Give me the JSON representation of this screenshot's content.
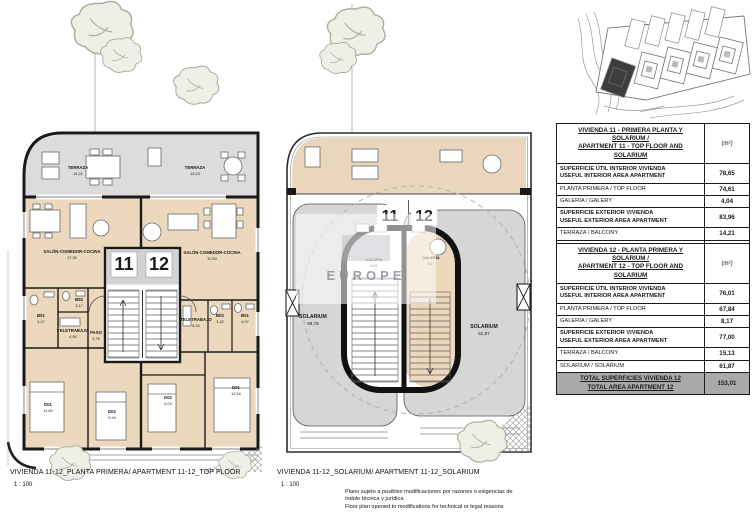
{
  "sheet": {
    "watermark": "EUROPE",
    "disclaimer_es": "Plano sujeto a posibles modificaciones por razones o exigencias de índole técnica y jurídica",
    "disclaimer_en": "Floor plan opened to modifications for technical or legal reasons"
  },
  "plan_top_floor": {
    "caption": "VIVIENDA 11-12_PLANTA PRIMERA/ APARTMENT 11-12_TOP FLOOR",
    "scale": "1 : 100",
    "unit_left": "11",
    "unit_right": "12",
    "rooms": {
      "terraza_11": {
        "name": "TERRAZA",
        "area": "14,21"
      },
      "terraza_12": {
        "name": "TERRAZA",
        "area": "15,13"
      },
      "salon_11": {
        "name": "SALÓN-COMEDOR-COCINA",
        "area": "27,36"
      },
      "salon_12": {
        "name": "SALÓN-COMEDOR-COCINA",
        "area": "30,50"
      },
      "b01_11": {
        "name": "B01",
        "area": "3,47"
      },
      "b02_11": {
        "name": "B02",
        "area": "3,17"
      },
      "teletrabajo_11": {
        "name": "TELETRABAJO",
        "area": "4,50"
      },
      "paso_11": {
        "name": "PASO",
        "area": "3,76"
      },
      "d01_11": {
        "name": "D01",
        "area": "11,69"
      },
      "d02_11": {
        "name": "D02",
        "area": "9,49"
      },
      "teletrabajo_12": {
        "name": "TELETRABAJO",
        "area": "5,34"
      },
      "b01_12": {
        "name": "B01",
        "area": "4,07"
      },
      "b02_12": {
        "name": "B02",
        "area": "3,42"
      },
      "d01_12": {
        "name": "D01",
        "area": "12,94"
      },
      "d02_12": {
        "name": "D02",
        "area": "9,04"
      }
    }
  },
  "plan_solarium": {
    "caption": "VIVIENDA 11-12_SOLARIUM/ APARTMENT 11-12_SOLARIUM",
    "scale": "1 : 100",
    "unit_left": "11",
    "unit_right": "12",
    "labels": {
      "solarium_11": {
        "name": "SOLARIUM",
        "area": "69,75"
      },
      "solarium_12": {
        "name": "SOLARIUM",
        "area": "61,87"
      },
      "galeria_11": {
        "name": "GALERÍA",
        "area": "4,04"
      },
      "galeria_12": {
        "name": "GALERÍA",
        "area": "8,17"
      }
    }
  },
  "tables": [
    {
      "title_es": "VIVIENDA 11 - PRIMERA PLANTA Y SOLARIUM /",
      "title_en": "APARTMENT 11 - TOP FLOOR AND SOLARIUM",
      "unit_header": "(m²)",
      "rows": [
        {
          "es": "SUPERFICIE ÚTIL INTERIOR VIVIENDA",
          "en": "USEFUL INTERIOR AREA APARTMENT",
          "value": "78,65"
        },
        {
          "es": "PLANTA PRIMERA / TOP FLOOR",
          "en": "",
          "value": "74,61"
        },
        {
          "es": "GALERÍA / GALERY",
          "en": "",
          "value": "4,04"
        },
        {
          "es": "SUPERFICIE EXTERIOR VIVIENDA",
          "en": "USEFUL EXTERIOR AREA APARTMENT",
          "value": "83,96"
        },
        {
          "es": "TERRAZA / BALCONY",
          "en": "",
          "value": "14,21"
        },
        {
          "es": "SOLARIUM / SOLARIUM",
          "en": "",
          "value": "69,75"
        }
      ],
      "total_es": "TOTAL SUPERFICIES VIVIENDA 11",
      "total_en": "TOTAL AREA APARTMENT 11",
      "total_value": "162,61"
    },
    {
      "title_es": "VIVIENDA 12 - PLANTA PRIMERA Y SOLARIUM /",
      "title_en": "APARTMENT 12 - TOP FLOOR AND SOLARIUM",
      "unit_header": "(m²)",
      "rows": [
        {
          "es": "SUPERFICIE ÚTIL INTERIOR VIVIENDA",
          "en": "USEFUL INTERIOR AREA APARTMENT",
          "value": "76,01"
        },
        {
          "es": "PLANTA PRIMERA / TOP FLOOR",
          "en": "",
          "value": "67,84"
        },
        {
          "es": "GALERÍA / GALERY",
          "en": "",
          "value": "8,17"
        },
        {
          "es": "SUPERFICIE EXTERIOR VIVIENDA",
          "en": "USEFUL EXTERIOR AREA APARTMENT",
          "value": "77,00"
        },
        {
          "es": "TERRAZA / BALCONY",
          "en": "",
          "value": "15,13"
        },
        {
          "es": "SOLARIUM / SOLARIUM",
          "en": "",
          "value": "61,87"
        }
      ],
      "total_es": "TOTAL SUPERFICIES VIVIENDA 12",
      "total_en": "TOTAL AREA APARTMENT 12",
      "total_value": "153,01"
    }
  ]
}
